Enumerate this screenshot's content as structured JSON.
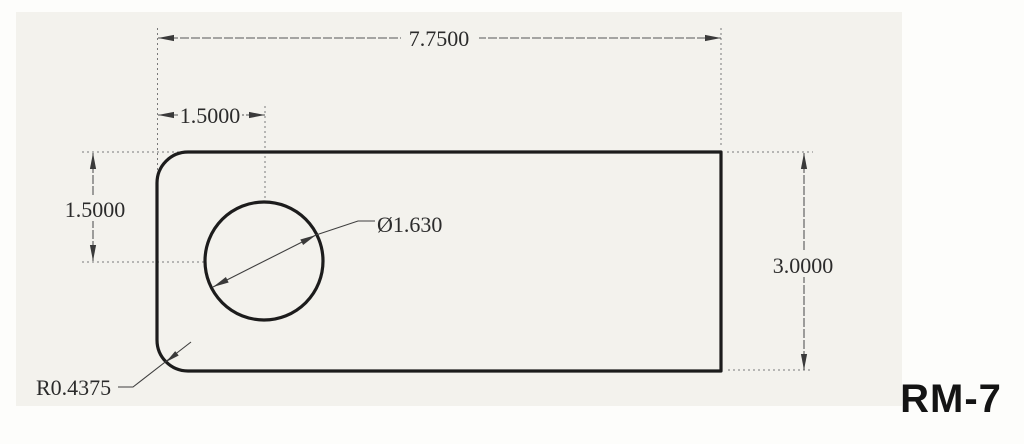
{
  "drawing": {
    "part_label": "RM-7",
    "dimensions": {
      "overall_width": "7.7500",
      "hole_offset_x": "1.5000",
      "hole_offset_y": "1.5000",
      "hole_diameter": "Ø1.630",
      "corner_radius": "R0.4375",
      "overall_height": "3.0000"
    },
    "colors": {
      "outline": "#1c1c1c",
      "dimension_line": "#565656",
      "extension_line": "#7a7a7a",
      "dimension_text": "#2b2b2b",
      "part_label_text": "#141414",
      "paper": "#f3f2ed",
      "background": "#fdfdfb"
    }
  }
}
